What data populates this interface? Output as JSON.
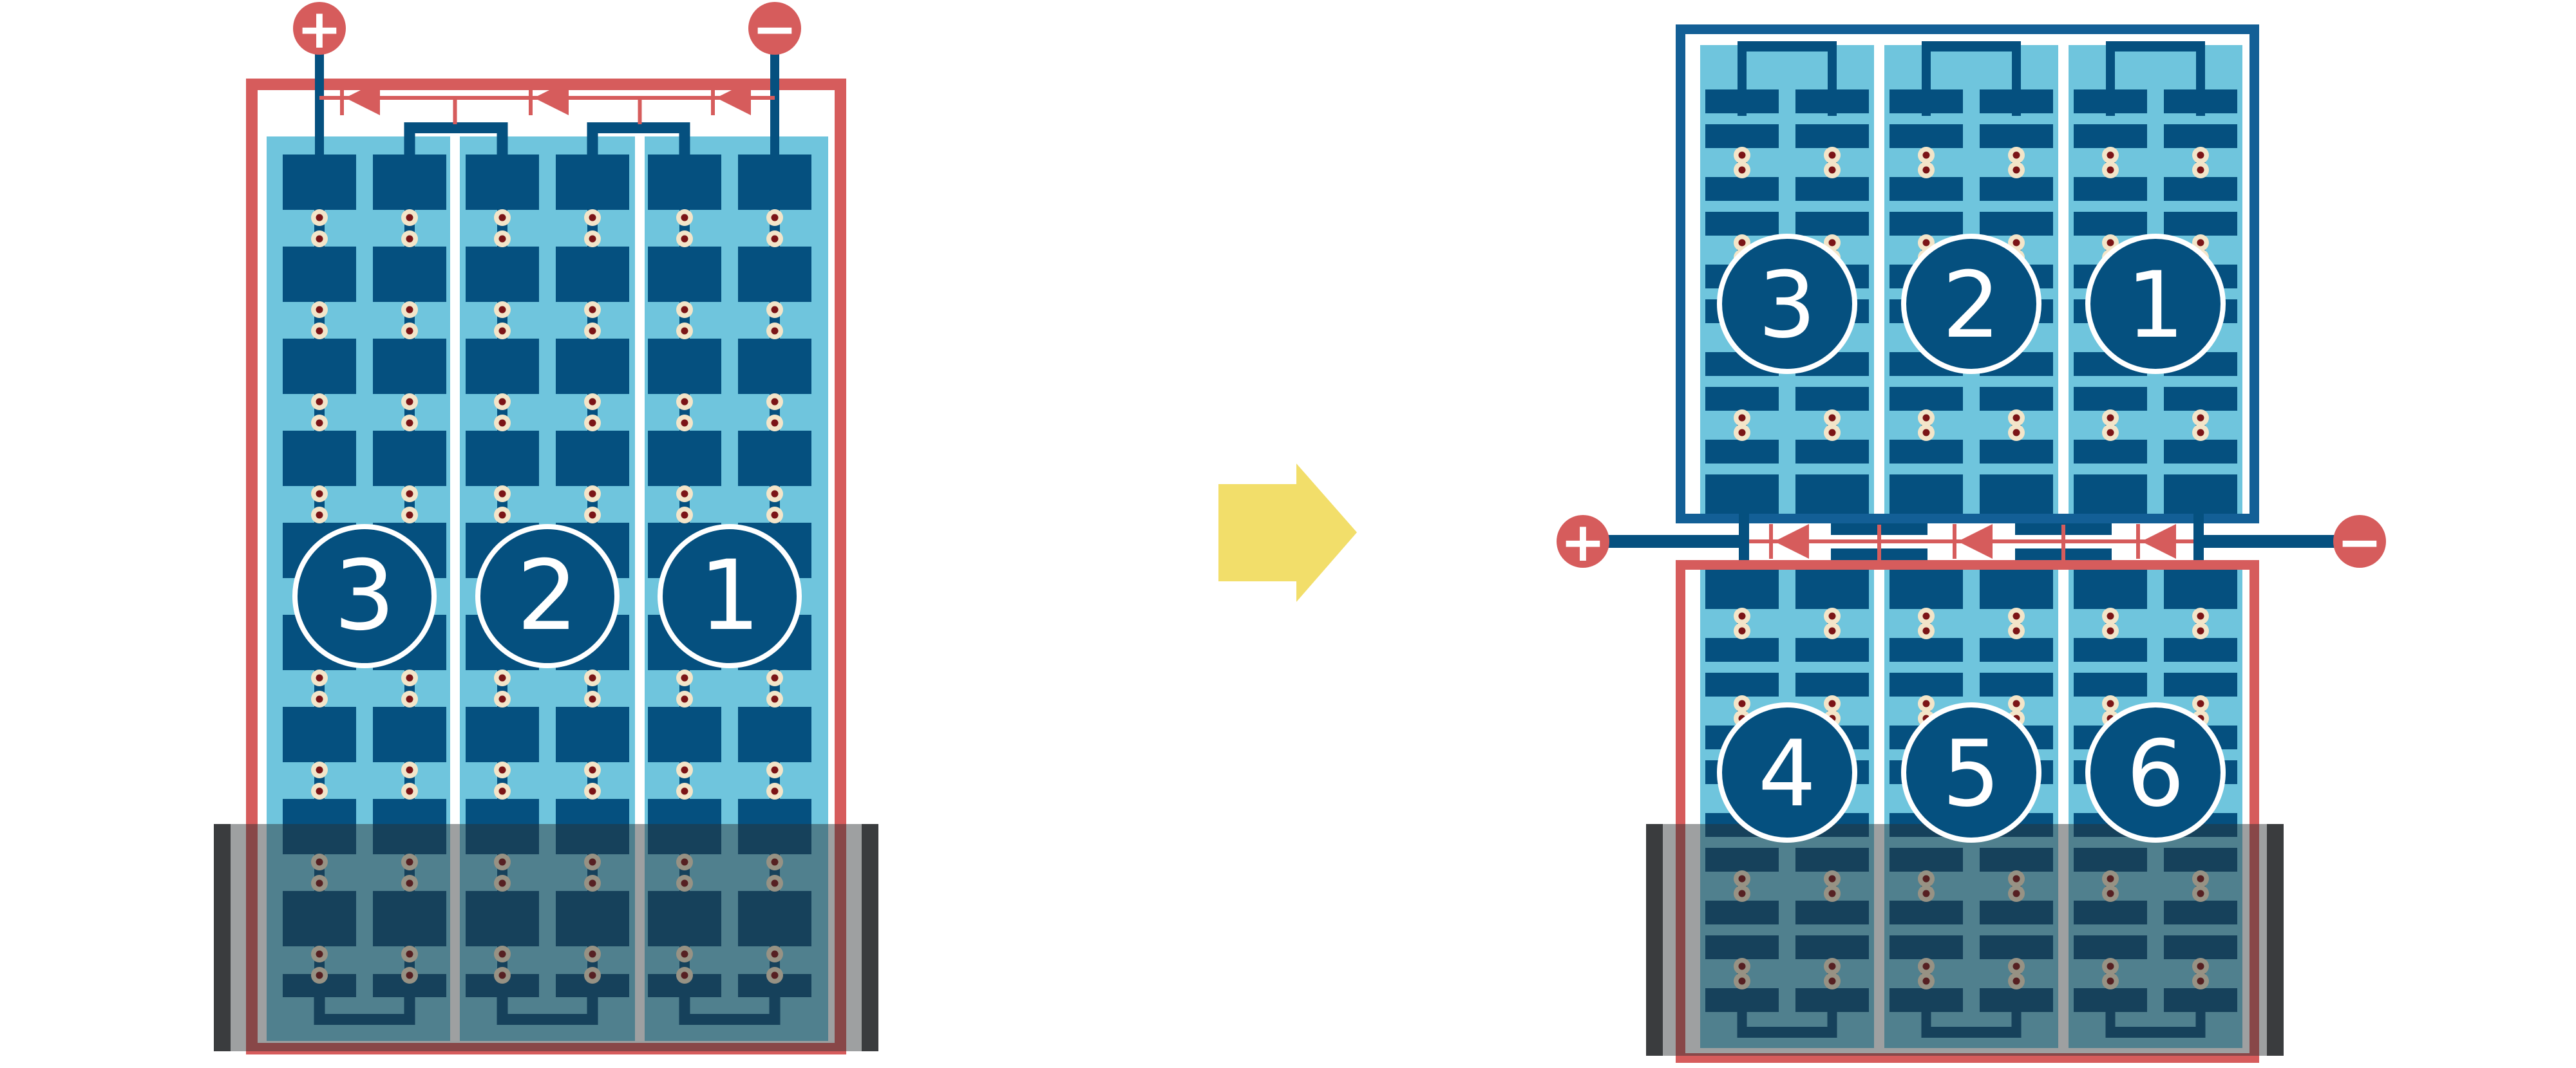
{
  "colors": {
    "red": "#D65C5C",
    "cell_blue": "#05507F",
    "frame_blue": "#135F96",
    "light_blue": "#6FC5DD",
    "dot_ring": "#F3E5C9",
    "dot_core": "#7B1416",
    "shadow": "rgba(43,47,51,0.46)",
    "shade_bar": "#3A3C3E",
    "arrow_yellow": "#F2DE6A",
    "badge_ring": "#FFFFFF",
    "background": "#FFFFFF"
  },
  "left_module": {
    "terminals": {
      "positive_label": "+",
      "negative_label": "−"
    },
    "sections": [
      {
        "label": "3"
      },
      {
        "label": "2"
      },
      {
        "label": "1"
      }
    ],
    "bypass_diode_count": 3,
    "cell_columns": 6,
    "cell_rows": 10,
    "shaded_bottom": true
  },
  "right_module": {
    "terminals": {
      "positive_label": "+",
      "negative_label": "−"
    },
    "top_half": {
      "sections": [
        {
          "label": "3"
        },
        {
          "label": "2"
        },
        {
          "label": "1"
        }
      ]
    },
    "bottom_half": {
      "sections": [
        {
          "label": "4"
        },
        {
          "label": "5"
        },
        {
          "label": "6"
        }
      ]
    },
    "bypass_diode_count": 3,
    "cell_columns": 6,
    "half_cell_rows_per_half": 10,
    "shaded_bottom": true
  },
  "transition_arrow": {
    "direction": "right"
  }
}
